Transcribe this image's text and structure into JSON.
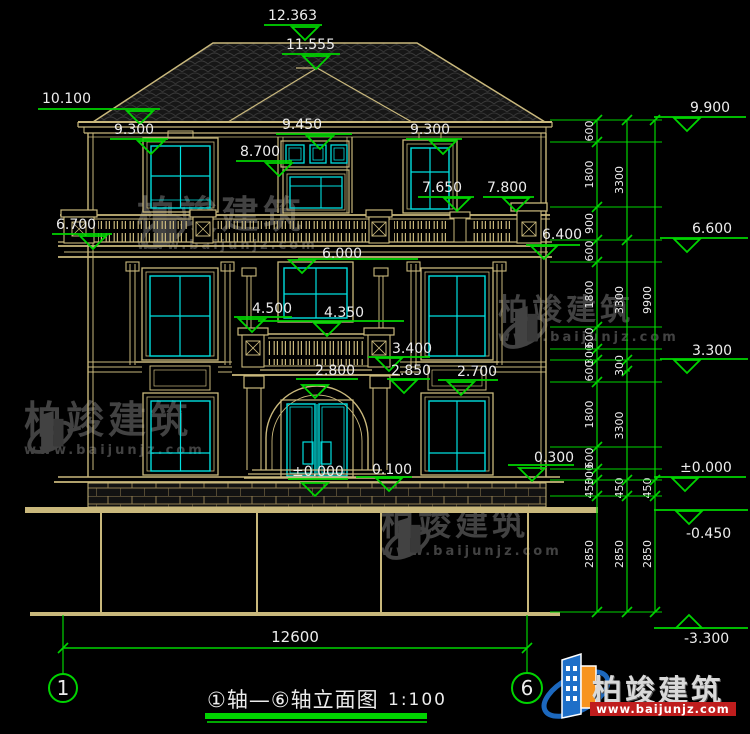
{
  "drawing": {
    "title": "①轴—⑥轴立面图",
    "scale_label": "1:100",
    "overall_width_dim": "12600",
    "axis_bubbles": [
      {
        "label": "1",
        "cx": 63,
        "cy": 688,
        "r": 14
      },
      {
        "label": "6",
        "cx": 527,
        "cy": 688,
        "r": 15
      }
    ]
  },
  "elevation_markers": [
    {
      "v": "12.363",
      "t": [
        268,
        8
      ],
      "l": [
        264,
        322,
        25
      ],
      "tri": [
        305,
        40
      ]
    },
    {
      "v": "11.555",
      "t": [
        286,
        37
      ],
      "l": [
        282,
        340,
        54
      ],
      "tri": [
        316,
        69
      ]
    },
    {
      "v": "10.100",
      "t": [
        42,
        91
      ],
      "l": [
        38,
        160,
        109
      ],
      "tri": [
        140,
        124
      ]
    },
    {
      "v": "9.300",
      "t": [
        114,
        122
      ],
      "l": [
        110,
        168,
        139
      ],
      "tri": [
        151,
        154
      ]
    },
    {
      "v": "9.450",
      "t": [
        282,
        117
      ],
      "l": [
        276,
        352,
        134
      ],
      "tri": [
        320,
        149
      ]
    },
    {
      "v": "9.300",
      "t": [
        410,
        122
      ],
      "l": [
        406,
        462,
        139
      ],
      "tri": [
        443,
        154
      ]
    },
    {
      "v": "8.700",
      "t": [
        240,
        144
      ],
      "l": [
        236,
        292,
        161
      ],
      "tri": [
        279,
        176
      ]
    },
    {
      "v": "7.650",
      "t": [
        422,
        180
      ],
      "l": [
        418,
        474,
        197
      ],
      "tri": [
        457,
        211
      ]
    },
    {
      "v": "7.800",
      "t": [
        487,
        180
      ],
      "l": [
        483,
        534,
        197
      ],
      "tri": [
        516,
        211
      ]
    },
    {
      "v": "6.700",
      "t": [
        56,
        217
      ],
      "l": [
        52,
        112,
        234
      ],
      "tri": [
        93,
        249
      ]
    },
    {
      "v": "6.400",
      "t": [
        542,
        227
      ],
      "l": [
        526,
        580,
        245
      ],
      "tri": [
        544,
        259
      ]
    },
    {
      "v": "6.000",
      "t": [
        322,
        246
      ],
      "l": [
        298,
        418,
        259
      ],
      "tri": [
        302,
        273
      ]
    },
    {
      "v": "4.500",
      "t": [
        252,
        301
      ],
      "l": [
        234,
        292,
        317
      ],
      "tri": [
        252,
        332
      ]
    },
    {
      "v": "4.350",
      "t": [
        324,
        305
      ],
      "l": [
        258,
        404,
        321
      ],
      "tri": [
        327,
        336
      ]
    },
    {
      "v": "3.400",
      "t": [
        392,
        341
      ],
      "l": [
        368,
        430,
        357
      ],
      "tri": [
        389,
        371
      ]
    },
    {
      "v": "2.850",
      "t": [
        391,
        363
      ],
      "l": [
        387,
        430,
        379
      ],
      "tri": [
        404,
        393
      ]
    },
    {
      "v": "2.800",
      "t": [
        315,
        363
      ],
      "l": [
        296,
        358,
        379
      ],
      "tri": [
        315,
        398
      ]
    },
    {
      "v": "2.700",
      "t": [
        457,
        364
      ],
      "l": [
        438,
        498,
        380
      ],
      "tri": [
        461,
        395
      ]
    },
    {
      "v": "±0.000",
      "t": [
        292,
        464
      ],
      "l": [
        288,
        348,
        479
      ],
      "tri": [
        315,
        496
      ]
    },
    {
      "v": "0.100",
      "t": [
        372,
        462
      ],
      "l": [
        356,
        412,
        477
      ],
      "tri": [
        389,
        491
      ]
    },
    {
      "v": "0.300",
      "t": [
        534,
        450
      ],
      "l": [
        508,
        574,
        465
      ],
      "tri": [
        532,
        481
      ]
    },
    {
      "v": "9.900",
      "t": [
        690,
        100
      ],
      "l": [
        654,
        746,
        117
      ],
      "tri": [
        687,
        131
      ]
    },
    {
      "v": "6.600",
      "t": [
        692,
        221
      ],
      "l": [
        660,
        748,
        238
      ],
      "tri": [
        687,
        252
      ]
    },
    {
      "v": "3.300",
      "t": [
        692,
        343
      ],
      "l": [
        660,
        748,
        359
      ],
      "tri": [
        687,
        373
      ]
    },
    {
      "v": "±0.000",
      "t": [
        680,
        460
      ],
      "l": [
        654,
        746,
        477
      ],
      "tri": [
        685,
        491
      ]
    },
    {
      "v": "-0.450",
      "t": [
        686,
        526
      ],
      "l": [
        654,
        748,
        510
      ],
      "tri": [
        689,
        524
      ]
    },
    {
      "v": "-3.300",
      "t": [
        684,
        631
      ],
      "l": [
        654,
        748,
        628
      ],
      "tri": [
        689,
        615
      ],
      "up": true
    }
  ],
  "dimension_chains": [
    {
      "x": 597,
      "ticks": [
        120,
        142,
        207,
        240,
        262,
        327,
        349,
        360,
        382,
        447,
        469,
        480,
        496,
        612
      ],
      "labels": [
        "600",
        "1800",
        "900",
        "600",
        "1800",
        "600",
        "300",
        "600",
        "1800",
        "600",
        "300",
        "450",
        "2850"
      ]
    },
    {
      "x": 627,
      "ticks": [
        120,
        240,
        360,
        371,
        480,
        496,
        612
      ],
      "labels": [
        "3300",
        "3300",
        "300",
        "3300",
        "450",
        "2850"
      ]
    },
    {
      "x": 655,
      "ticks": [
        120,
        480,
        496,
        612
      ],
      "labels": [
        "9900",
        "450",
        "2850"
      ]
    }
  ],
  "bottom_dimension": {
    "label": "12600",
    "y": 648,
    "x1": 63,
    "x2": 527
  },
  "watermarks": {
    "text": "柏竣建筑",
    "url": "www.baijunjz.com",
    "instances": [
      {
        "x": 137,
        "y": 196,
        "icon": true,
        "size": 38
      },
      {
        "x": 498,
        "y": 296,
        "icon": true,
        "size": 30
      },
      {
        "x": 24,
        "y": 401,
        "icon": true,
        "size": 38
      },
      {
        "x": 381,
        "y": 507,
        "icon": true,
        "size": 33
      }
    ]
  },
  "logo": {
    "brand": "柏竣建筑",
    "url": "www.baijunjz.com"
  },
  "colors": {
    "background": "#000000",
    "line_tan": "#c9b87c",
    "brick_tan": "#917f52",
    "window_cyan": "#00dfdf",
    "dim_green": "#00d400",
    "text_white": "#ededed",
    "watermark_gray": "#424242",
    "roof_fill": "#161616",
    "logo_blue": "#1e6fc8",
    "logo_orange": "#f7941e",
    "logo_red": "#bf1d1d"
  }
}
